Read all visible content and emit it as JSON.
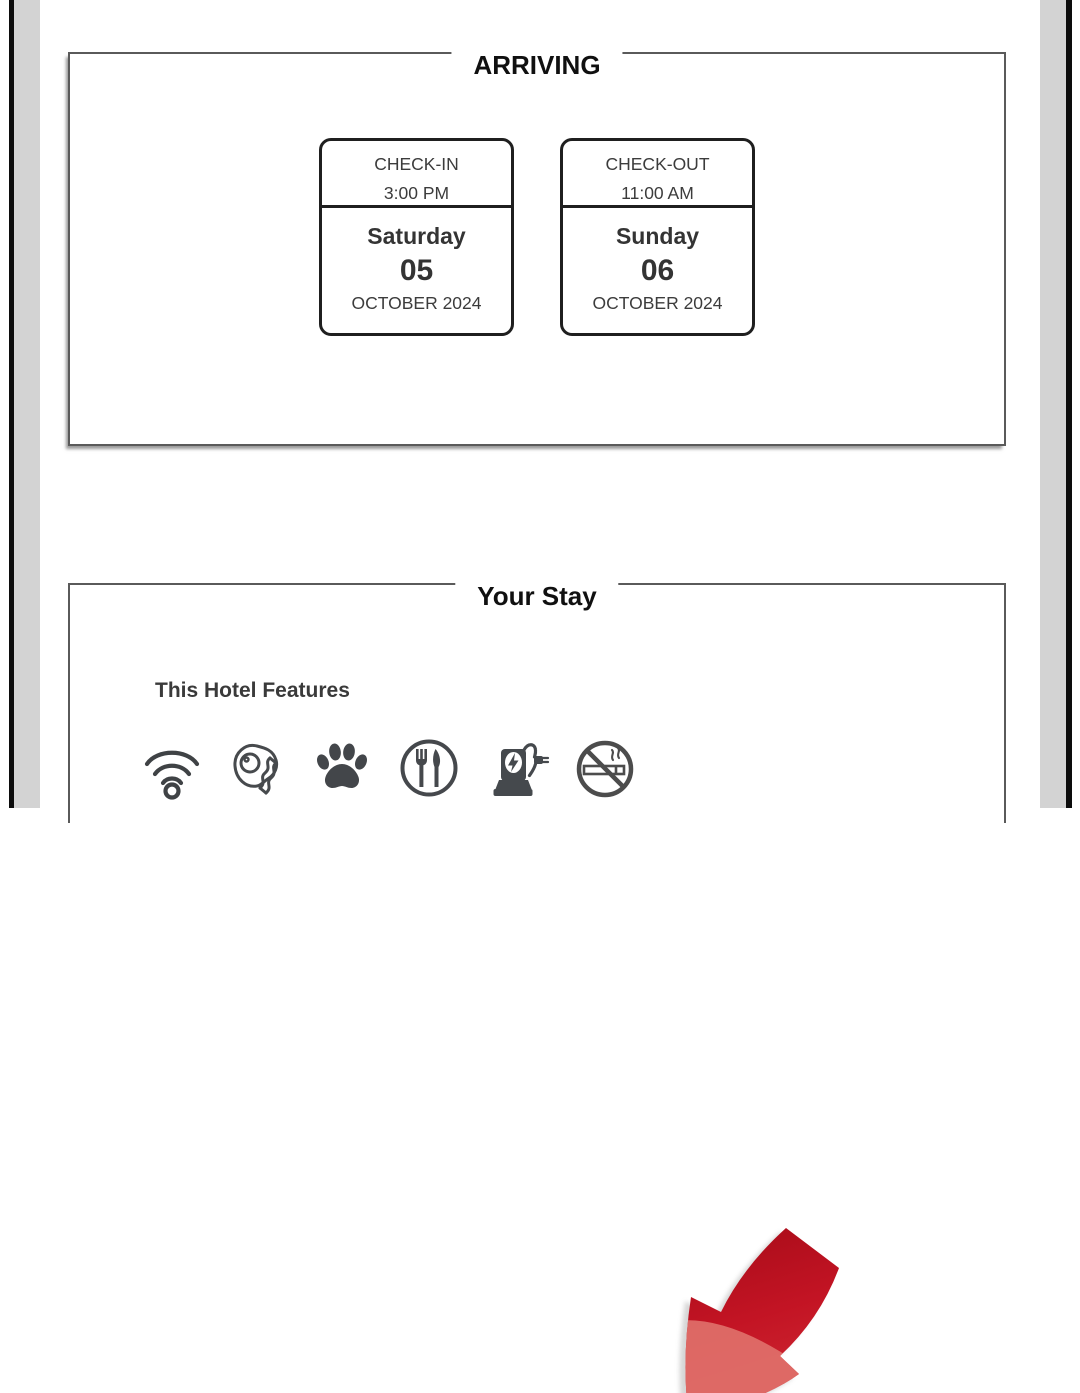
{
  "page": {
    "kind": "hotel-confirmation-document",
    "background": "#ffffff",
    "edge_black": "#0c0c0c",
    "edge_gray": "#d3d3d3",
    "panel_border": "#5a5a5a"
  },
  "arriving": {
    "title": "ARRIVING",
    "checkin": {
      "label": "CHECK-IN",
      "time": "3:00 PM",
      "day_name": "Saturday",
      "day_number": "05",
      "month_year": "OCTOBER 2024"
    },
    "checkout": {
      "label": "CHECK-OUT",
      "time": "11:00 AM",
      "day_name": "Sunday",
      "day_number": "06",
      "month_year": "OCTOBER 2024"
    }
  },
  "your_stay": {
    "title": "Your Stay",
    "features_heading": "This Hotel Features",
    "features": [
      {
        "name": "wifi",
        "icon": "wifi-icon"
      },
      {
        "name": "breakfast",
        "icon": "breakfast-icon"
      },
      {
        "name": "pets-allowed",
        "icon": "paw-icon"
      },
      {
        "name": "restaurant",
        "icon": "restaurant-icon"
      },
      {
        "name": "ev-charging",
        "icon": "ev-charging-icon"
      },
      {
        "name": "no-smoking",
        "icon": "no-smoking-icon"
      }
    ],
    "annotation": {
      "shape": "red-arrow",
      "direction": "down-left",
      "points_at": "no-smoking",
      "color_dark": "#b20f1d",
      "color_light": "#e0716b"
    }
  },
  "colors": {
    "icon_gray": "#45494d",
    "card_border": "#1f1f1f",
    "text_dark": "#343434"
  }
}
